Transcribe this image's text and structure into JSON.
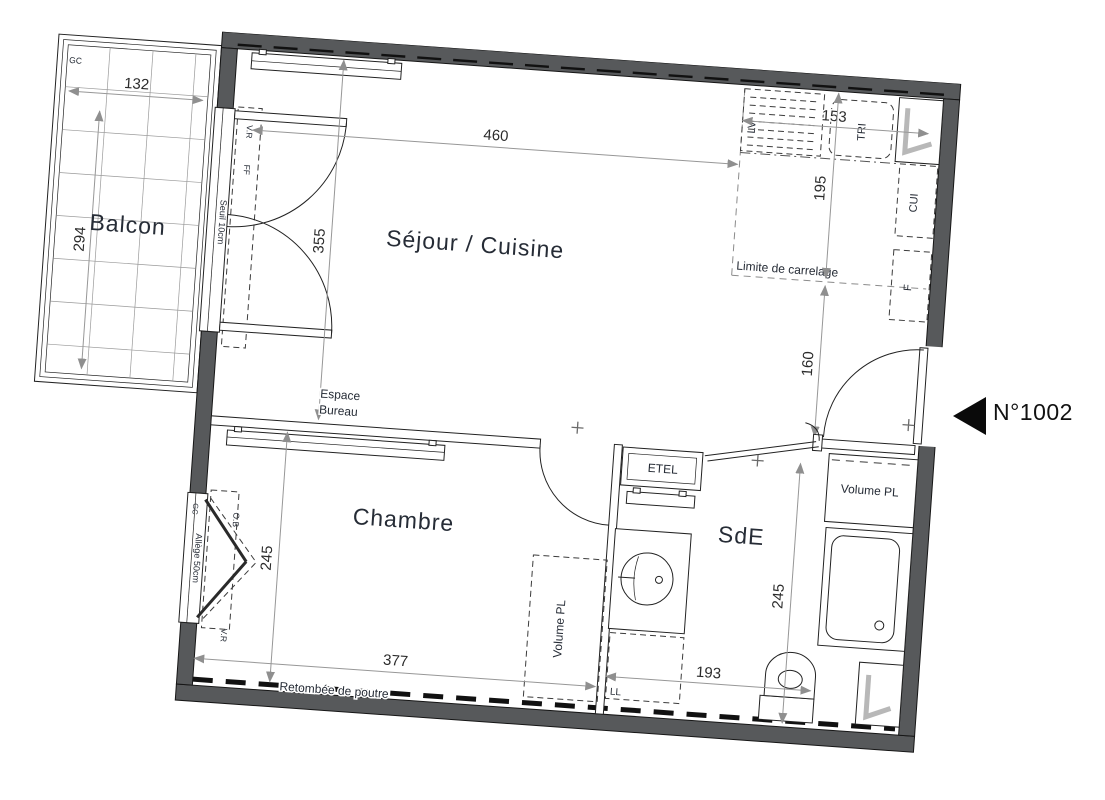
{
  "unit": {
    "number": "N°1002"
  },
  "rooms": {
    "balcon": "Balcon",
    "sejour": "Séjour / Cuisine",
    "chambre": "Chambre",
    "sde": "SdE"
  },
  "dims": {
    "balcon_w": "132",
    "balcon_h": "294",
    "sejour_w": "460",
    "sejour_h": "355",
    "kitchen_w": "153",
    "kitchen_h": "195",
    "entry_h": "160",
    "chambre_h": "245",
    "chambre_w": "377",
    "sde_h": "245",
    "sde_w": "193"
  },
  "labels": {
    "gc_balcon": "GC",
    "gc_window": "GC",
    "vr_top": "V.R",
    "ff": "FF",
    "seuil": "Seuil 10cm",
    "lv": "LV",
    "tri": "TRI",
    "cui": "CUI",
    "f": "F",
    "limite_carrelage": "Limite de carrelage",
    "espace_line1": "Espace",
    "espace_line2": "Bureau",
    "etel": "ETEL",
    "volume_pl_entry": "Volume PL",
    "volume_pl_chambre": "Volume PL",
    "ll": "LL",
    "allege": "Allège 50cm",
    "ob": "O.B",
    "vr_window": "V.R",
    "retombee": "Retombée de poutre"
  },
  "colors": {
    "wall": "#57595b",
    "line": "#161616",
    "dim": "#979797",
    "text": "#262c36",
    "glazing": "#b8b8b8"
  }
}
